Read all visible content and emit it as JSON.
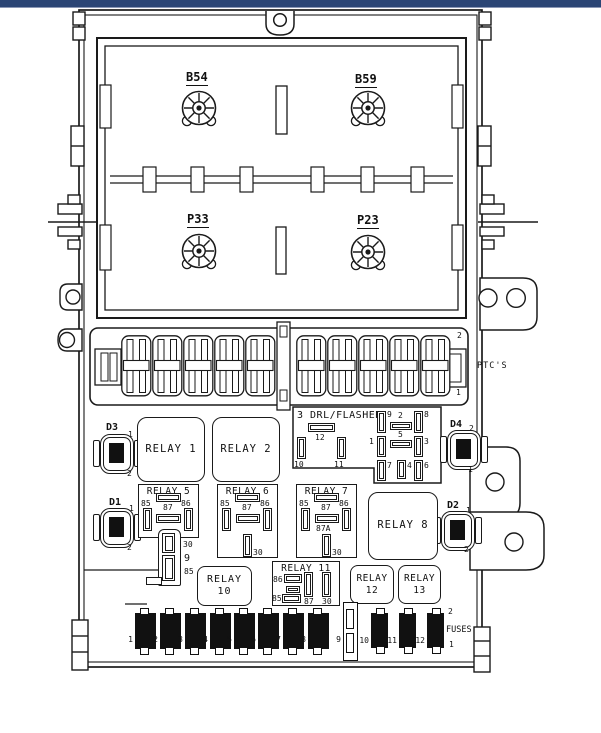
{
  "colors": {
    "top_bar": "#2b4575",
    "line": "#1a1a1a"
  },
  "cover_labels": {
    "b54": "B54",
    "b59": "B59",
    "p33": "P33",
    "p23": "P23"
  },
  "ptc_strip": {
    "pin_top": "2",
    "pin_bottom": "1",
    "label": "PTC'S"
  },
  "drl_block": {
    "title": "3 DRL/FLASHER",
    "pin_12": "12",
    "pin_10": "10",
    "pin_11": "11",
    "pin_9": "9",
    "pin_2": "2",
    "pin_8": "8",
    "pin_1": "1",
    "pin_5": "5",
    "pin_3": "3",
    "pin_7": "7",
    "pin_4": "4",
    "pin_6": "6"
  },
  "diodes": {
    "d1": {
      "label": "D1",
      "top": "1",
      "bottom": "2"
    },
    "d2": {
      "label": "D2",
      "top": "1",
      "bottom": "2"
    },
    "d3": {
      "label": "D3",
      "top": "1",
      "bottom": "2"
    },
    "d4": {
      "label": "D4",
      "top": "2",
      "bottom": "1"
    }
  },
  "relays": {
    "r1": {
      "name": "RELAY 1"
    },
    "r2": {
      "name": "RELAY 2"
    },
    "r5": {
      "name": "RELAY 5",
      "pin_85": "85",
      "pin_87": "87",
      "pin_86": "86",
      "stack_30": "30",
      "stack_9": "9",
      "stack_85": "85"
    },
    "r6": {
      "name": "RELAY 6",
      "pin_85": "85",
      "pin_87": "87",
      "pin_86": "86",
      "pin_30": "30"
    },
    "r7": {
      "name": "RELAY 7",
      "pin_85": "85",
      "pin_87": "87",
      "pin_87a": "87A",
      "pin_86": "86",
      "pin_30": "30"
    },
    "r8": {
      "name": "RELAY 8"
    },
    "r10": {
      "name": "RELAY 10"
    },
    "r11": {
      "name": "RELAY 11",
      "pin_86": "86",
      "pin_85": "85",
      "pin_87": "87",
      "pin_30": "30"
    },
    "r12": {
      "line1": "RELAY",
      "line2": "12"
    },
    "r13": {
      "line1": "RELAY",
      "line2": "13"
    }
  },
  "fuse_row": {
    "label": "FUSES",
    "pin_top": "2",
    "pin_bottom": "1",
    "numbers": [
      "1",
      "2",
      "3",
      "4",
      "5",
      "6",
      "7",
      "8",
      "9",
      "10",
      "11",
      "12"
    ]
  }
}
